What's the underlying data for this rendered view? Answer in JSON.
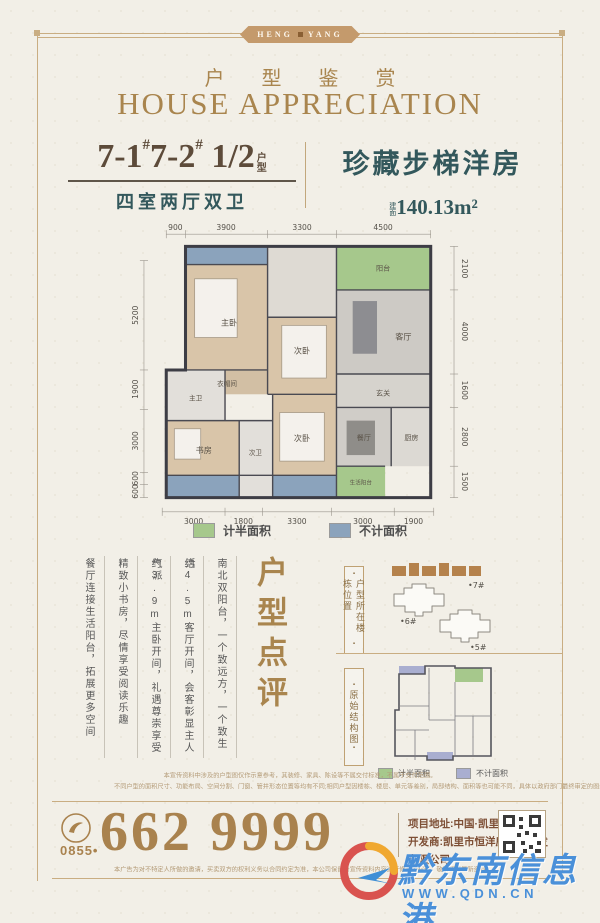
{
  "brand": {
    "ribbon_left": "HENG",
    "ribbon_right": "YANG"
  },
  "header": {
    "title_cn": "户 型 鉴 赏",
    "title_en": "HOUSE APPRECIATION"
  },
  "unit": {
    "num_a": "7-1",
    "hash_a": "#",
    "num_b": "7-2",
    "hash_b": "#",
    "fraction": "1/2",
    "suffix_top": "户",
    "suffix_bottom": "型",
    "layout": "四室两厅双卫",
    "type_name": "珍藏步梯洋房",
    "area_prefix_top": "建",
    "area_prefix_bottom": "面",
    "area": "140.13m²"
  },
  "floorplan": {
    "dims_top": [
      "900",
      "3900",
      "3300",
      "4500"
    ],
    "dims_bottom": [
      "3000",
      "1800",
      "3300",
      "3000",
      "1900"
    ],
    "dims_left": [
      "5200",
      "1900",
      "3000",
      "600",
      "600"
    ],
    "dims_right": [
      "2100",
      "4000",
      "1600",
      "2800",
      "1500"
    ],
    "rooms": {
      "master": "主卧",
      "closet": "衣帽间",
      "bedroom2": "次卧",
      "bath_master": "主卫",
      "study": "书房",
      "bath2": "次卫",
      "bedroom3": "次卧",
      "living": "客厅",
      "dining": "餐厅",
      "kitchen": "厨房",
      "foyer": "玄关",
      "balcony": "阳台",
      "life_balcony": "生活阳台"
    }
  },
  "legend": {
    "half": "计半面积",
    "excluded": "不计面积"
  },
  "colors": {
    "half_area": "#a6c88c",
    "excluded_area": "#8ba3bc"
  },
  "review": {
    "title": "户型点评",
    "columns": [
      "南北双阳台，一个致远方，一个致生活",
      "约4.5m客厅开间，会客彰显主人气派",
      "约3.9m主卧开间，礼遇尊崇享受",
      "精致小书房，尽情享受阅读乐趣",
      "餐厅连接生活阳台，拓展更多空间"
    ]
  },
  "diagrams": {
    "location_label": "户型所在楼栋位置",
    "bullet": "▪",
    "buildings": [
      "•7#",
      "•6#",
      "•5#"
    ],
    "structure_label": "原始结构图",
    "legend_half": "计半面积",
    "legend_excluded": "不计面积"
  },
  "disclaimer": {
    "line1": "本宣传资料中涉及的户型图仅作示意参考，其装修、家具、陈设等不属交付标准，不属于交付范围。",
    "line2": "不同户型的面积尺寸、功能布局、空间分割、门窗、管井形态位置等均有不同;相同户型因楼栋、楼层、单元等差别，局部结构、面积等也可能不同，具体以政府部门最终审定的图纸和销售合同为准。",
    "bottom": "本广告为对不特定人所做的邀请，买卖双方的权利义务以合同约定为准，本公司保留对宣传资料内容进行修改的权利，敬请留意最新资料。"
  },
  "contact": {
    "area_code": "0855•",
    "phone": "662 9999",
    "address": "项目地址:中国·凯里·八小旁",
    "developer": "开发商:凯里市恒洋房地产开发有限公司"
  },
  "watermark": {
    "site_name": "黔东南信息港",
    "site_url": "WWW.QDN.CN"
  }
}
